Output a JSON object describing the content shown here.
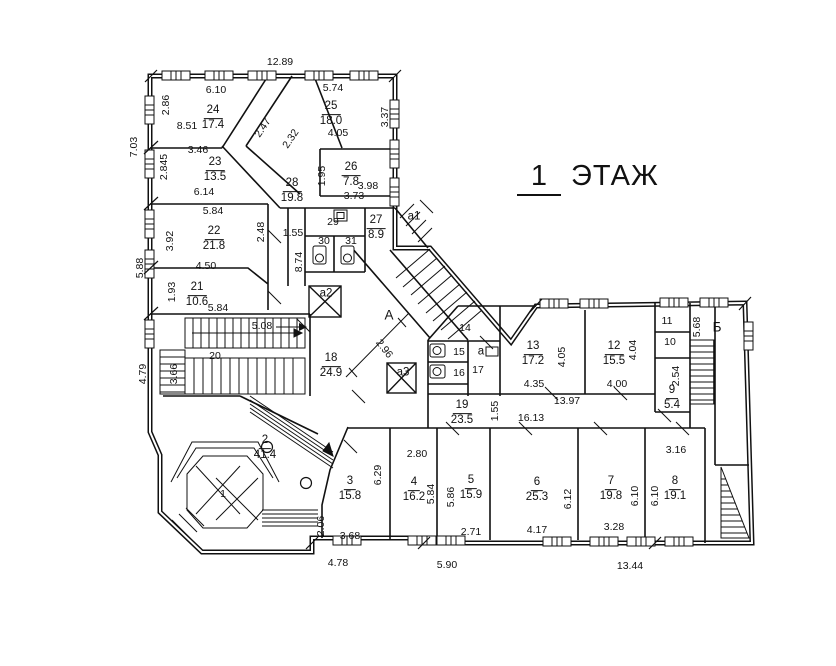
{
  "title": {
    "floor_number": "1",
    "floor_word": "ЭТАЖ"
  },
  "rooms": {
    "r1": {
      "number": "1"
    },
    "r2": {
      "number": "2",
      "area": "41.4"
    },
    "r3": {
      "number": "3",
      "area": "15.8"
    },
    "r4": {
      "number": "4",
      "area": "16.2"
    },
    "r5": {
      "number": "5",
      "area": "15.9"
    },
    "r6": {
      "number": "6",
      "area": "25.3"
    },
    "r7": {
      "number": "7",
      "area": "19.8"
    },
    "r8": {
      "number": "8",
      "area": "19.1"
    },
    "r9": {
      "number": "9",
      "area": "5.4"
    },
    "r10": {
      "number": "10"
    },
    "r11": {
      "number": "11"
    },
    "r12": {
      "number": "12",
      "area": "15.5"
    },
    "r13": {
      "number": "13",
      "area": "17.2"
    },
    "r14": {
      "number": "14"
    },
    "r15": {
      "number": "15"
    },
    "r16": {
      "number": "16"
    },
    "r17": {
      "number": "17"
    },
    "r18": {
      "number": "18",
      "area": "24.9"
    },
    "r19": {
      "number": "19",
      "area": "23.5"
    },
    "r20": {
      "number": "20"
    },
    "r21": {
      "number": "21",
      "area": "10.6"
    },
    "r22": {
      "number": "22",
      "area": "21.8"
    },
    "r23": {
      "number": "23",
      "area": "13.5"
    },
    "r24": {
      "number": "24",
      "area": "17.4"
    },
    "r25": {
      "number": "25",
      "area": "18.0"
    },
    "r26": {
      "number": "26",
      "area": "7.8"
    },
    "r27": {
      "number": "27",
      "area": "8.9"
    },
    "r28": {
      "number": "28",
      "area": "19.8"
    },
    "r29": {
      "number": "29"
    },
    "r30": {
      "number": "30"
    },
    "r31": {
      "number": "31"
    }
  },
  "zones": {
    "stair_a1": "а1",
    "stair_a": "а",
    "lift_a2": "а2",
    "lift_a3": "а3",
    "corridor_a": "А",
    "stair_b": "Б"
  },
  "dims": {
    "top_width": "12.89",
    "left_upper": "7.03",
    "left_middle": "5.88",
    "left_lower": "4.79",
    "bottom_left": "4.78",
    "bottom_middle": "5.90",
    "bottom_right": "13.44",
    "stair_b_height": "5.68",
    "r24_width": "6.10",
    "r24_left": "2.86",
    "r24_bottom": "8.51",
    "r25_width": "5.74",
    "r25_bottom": "4.05",
    "r25_right": "3.37",
    "corridor_d1": "2.47",
    "corridor_d2": "2.32",
    "r23_top": "3.46",
    "r23_left": "2.845",
    "r23_bottom": "6.14",
    "r26_left": "1.95",
    "r26_bottom": "3.98",
    "r28_right": "3.73",
    "r22_top": "5.84",
    "r22_left": "3.92",
    "r22_right": "2.48",
    "r22_bottom": "4.50",
    "r21_left": "1.93",
    "r21_bottom": "5.84",
    "r20_top": "5.08",
    "r20_left": "3.66",
    "c29_left": "1.55",
    "c29_height": "8.74",
    "hall_diag": "2.96",
    "r13_right": "4.05",
    "r13_bottom": "4.35",
    "r12_right": "4.04",
    "r12_bottom": "4.00",
    "chain_13_97": "13.97",
    "chain_16_13": "16.13",
    "r19_right": "1.55",
    "r9_left": "2.54",
    "r3_right": "6.29",
    "r3_bottom": "3.68",
    "r3_left": "2.06",
    "r4_top": "2.80",
    "r4_right": "5.84",
    "r5_left": "5.86",
    "r5_bottom": "2.71",
    "r6_right": "6.12",
    "r6_bottom": "4.17",
    "r7_right": "6.10",
    "r7_bottom": "3.28",
    "r8_left": "6.10",
    "r8_top": "3.16"
  }
}
